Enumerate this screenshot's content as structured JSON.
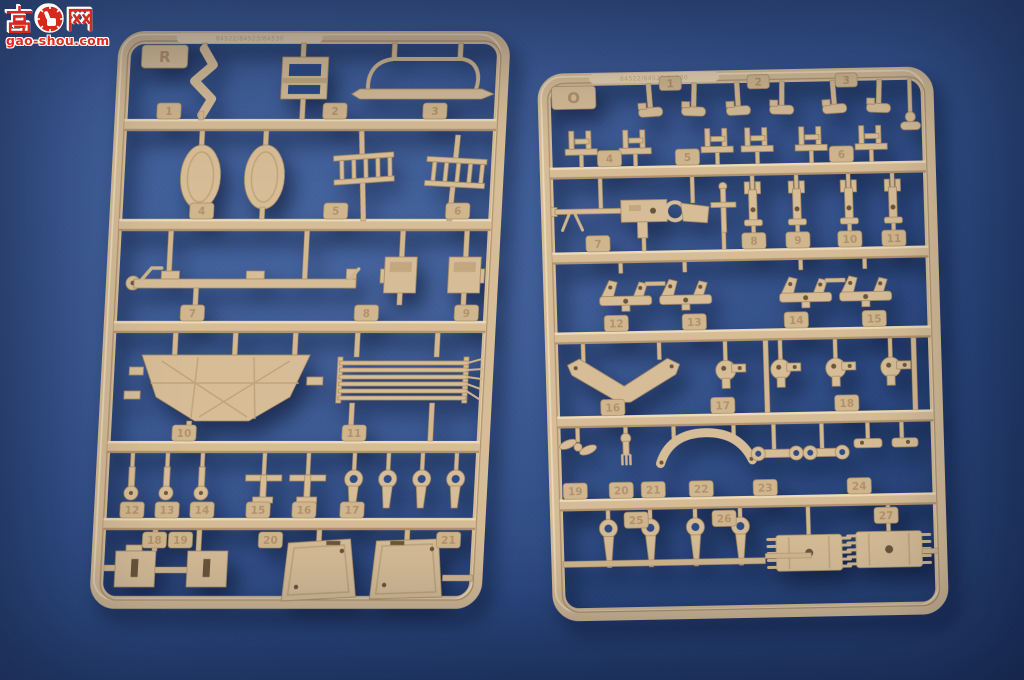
{
  "watermark": {
    "char_left": "高",
    "char_right": "网",
    "badge_icon": "thumbs-up-gear-icon",
    "domain": "gao-shou.com",
    "accent_color": "#d6281c"
  },
  "scene": {
    "background_color": "#33528f",
    "plastic_color": "#d6bd97",
    "subject": "two tan plastic model kit sprues photographed on blue background"
  },
  "sprues": [
    {
      "letter": "R",
      "mold_text": "84522/84523/84530",
      "part_numbers": [
        "1",
        "2",
        "3",
        "4",
        "5",
        "6",
        "7",
        "8",
        "9",
        "10",
        "11",
        "12",
        "13",
        "14",
        "15",
        "16",
        "17",
        "18",
        "19",
        "20",
        "21"
      ]
    },
    {
      "letter": "O",
      "mold_text": "84522/84523/84530",
      "part_numbers": [
        "1",
        "2",
        "3",
        "4",
        "5",
        "6",
        "7",
        "8",
        "9",
        "10",
        "11",
        "12",
        "13",
        "14",
        "15",
        "16",
        "17",
        "18",
        "19",
        "20",
        "21",
        "22",
        "23",
        "24",
        "25",
        "26",
        "27"
      ]
    }
  ]
}
